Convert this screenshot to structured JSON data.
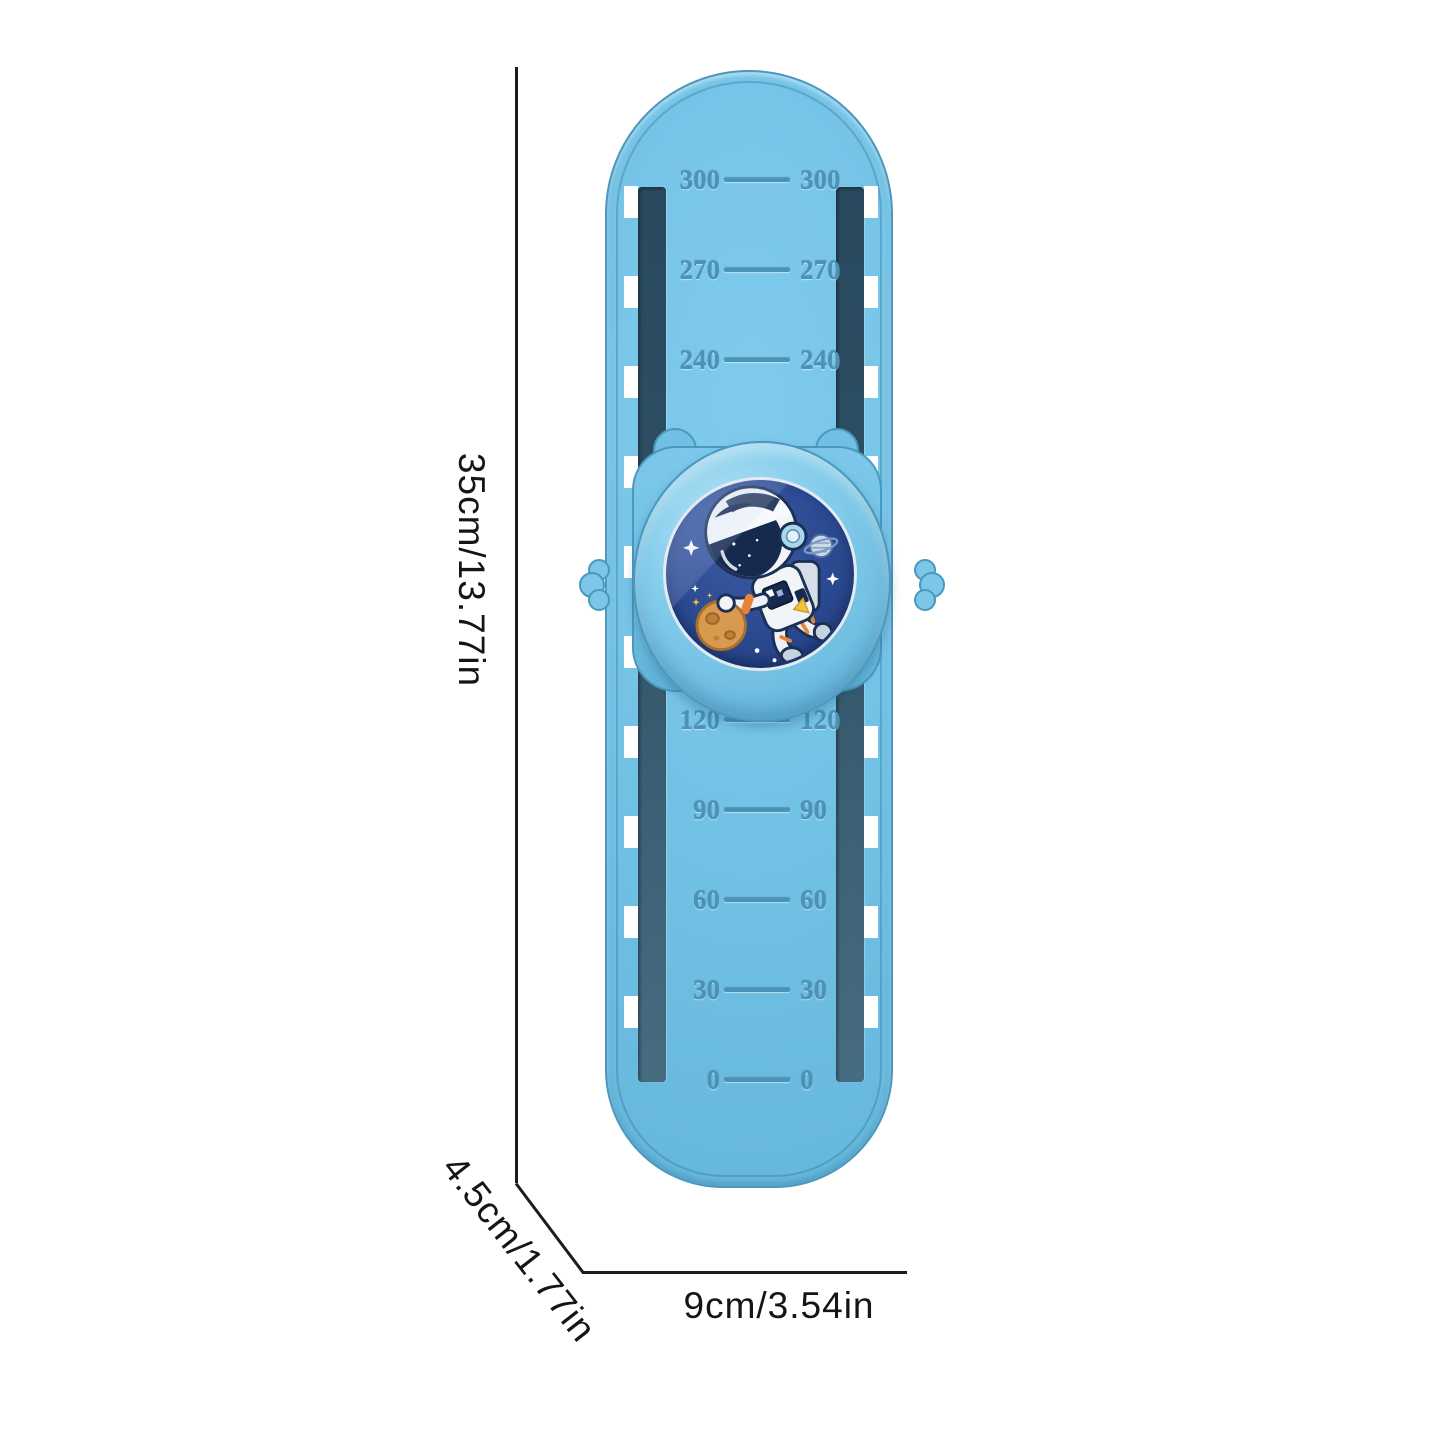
{
  "product": {
    "kind": "height-measuring slap ruler with rotating astronaut knob",
    "dimensions": {
      "height_label": "35cm/13.77in",
      "depth_label": "4.5cm/1.77in",
      "width_label": "9cm/3.54in"
    },
    "scale": {
      "upper_values": [
        "300",
        "270",
        "240"
      ],
      "lower_values": [
        "120",
        "90",
        "60",
        "30",
        "0"
      ],
      "sides": [
        "left",
        "right"
      ],
      "notches_per_side": 10
    },
    "knob": {
      "illustration": "cartoon astronaut holding an orange moon in space",
      "icons": [
        "astronaut-icon",
        "astronaut-helmet-icon",
        "moon-icon",
        "saturn-icon",
        "star-icon",
        "sparkle-icon"
      ]
    },
    "colors": {
      "body_blue": "#72c2e5",
      "body_blue_dark": "#4b98be",
      "channel_dark": "#2e4f63",
      "scale_text": "#4a92b8",
      "knob_plate": "#6fc0e2",
      "ring_blue": "#84cdec",
      "glass_navy": "#2b4a92",
      "moon_orange": "#d89a4f",
      "dimension_line": "#1c1c1c",
      "background": "#ffffff"
    }
  }
}
